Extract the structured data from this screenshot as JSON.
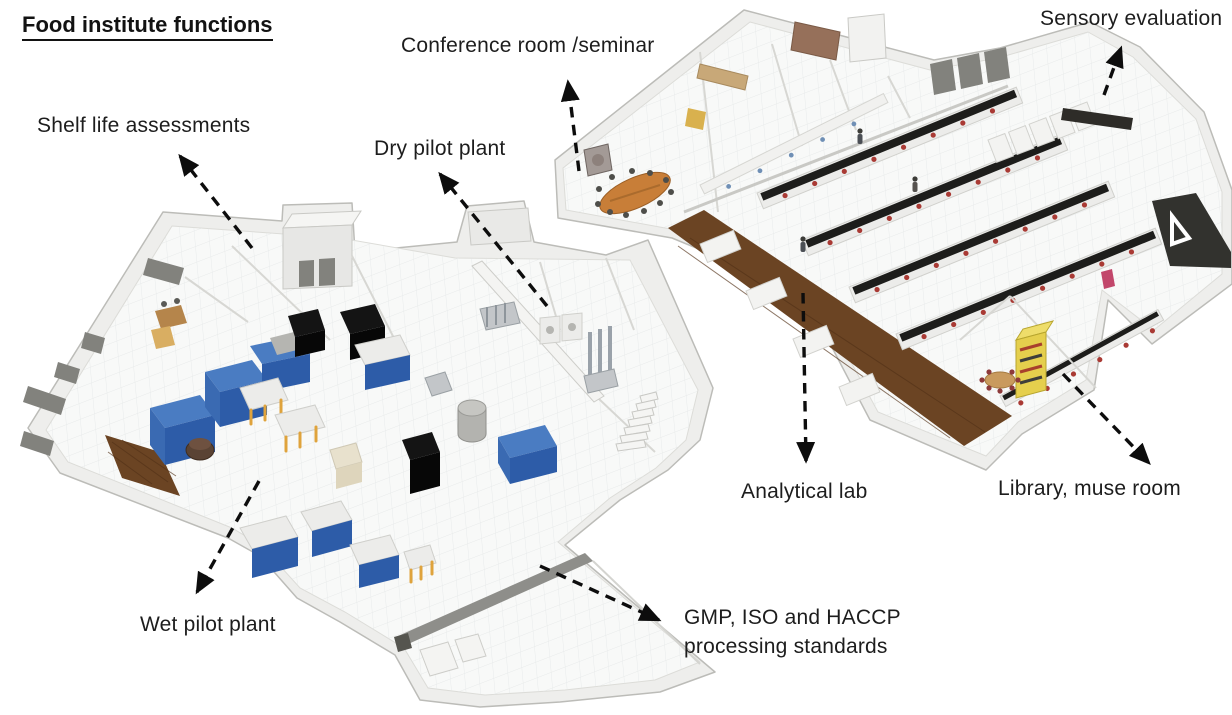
{
  "title": "Food institute functions",
  "labels": {
    "shelf_life": "Shelf life assessments",
    "conference": "Conference room /seminar",
    "dry_pilot": "Dry pilot plant",
    "sensory": "Sensory evaluation",
    "analytical": "Analytical lab",
    "library": "Library, muse room",
    "wet_pilot": "Wet pilot plant",
    "gmp_line1": "GMP, ISO and HACCP",
    "gmp_line2": "processing standards"
  },
  "colors": {
    "background": "#ffffff",
    "text": "#1d1d1d",
    "arrow": "#0d0d0d",
    "wall": "#eeeeec",
    "wall_edge": "#bcbcb8",
    "floor": "#f8f9f8",
    "wood": "#6b4423",
    "blue_top": "#4a7cc2",
    "blue_front": "#2d5ca8",
    "black_equipment": "#141414",
    "yellow_legs": "#dfa33c",
    "orange_table": "#c87e38",
    "yellow_shelf": "#e5cf4d",
    "bench_top": "#1d1d1b",
    "red_seat": "#a93a34",
    "window_gray": "#82827d",
    "dark_floor": "#32322e"
  }
}
